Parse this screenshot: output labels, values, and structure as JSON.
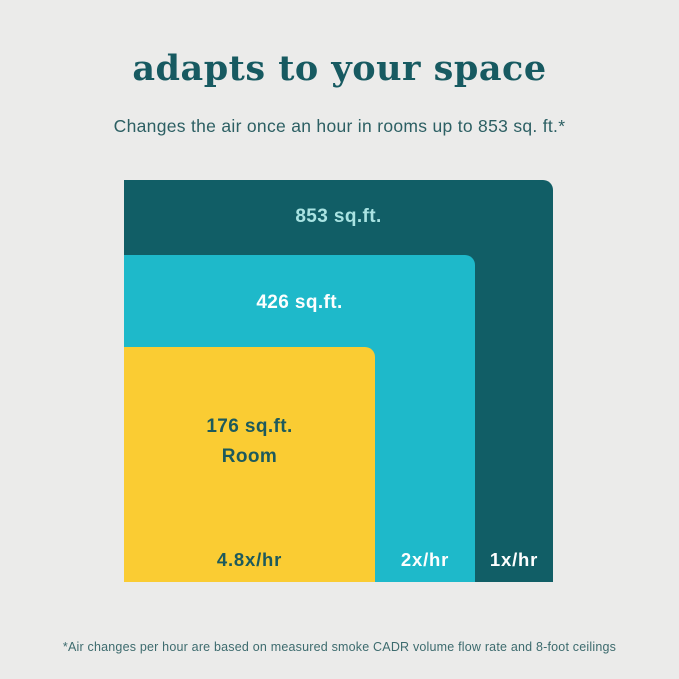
{
  "header": {
    "title": "adapts to your space",
    "subtitle": "Changes the air once an hour in rooms up to 853 sq. ft.*"
  },
  "diagram": {
    "rooms": [
      {
        "label": "853 sq.ft.",
        "rate": "1x/hr",
        "sqft": 853,
        "color": "#115E66"
      },
      {
        "label": "426 sq.ft.",
        "rate": "2x/hr",
        "sqft": 426,
        "color": "#1EB9CA"
      },
      {
        "label": "176 sq.ft.",
        "sublabel": "Room",
        "rate": "4.8x/hr",
        "sqft": 176,
        "color": "#FACC33"
      }
    ]
  },
  "footer": {
    "note": "*Air changes per hour are based on measured smoke CADR volume flow rate and 8-foot ceilings"
  },
  "colors": {
    "background": "#EBEBEA",
    "dark_teal": "#115E66",
    "cyan": "#1EB9CA",
    "yellow": "#FACC33",
    "title_text": "#175A61",
    "light_cyan_label": "#A9E3E2",
    "white_label": "#FDFEFE",
    "dark_label": "#1D5A5C",
    "footnote_text": "#3D6B6E"
  },
  "chart_data": {
    "type": "area",
    "title": "adapts to your space",
    "subtitle": "Changes the air once an hour in rooms up to 853 sq. ft.*",
    "categories": [
      "853 sq.ft.",
      "426 sq.ft.",
      "176 sq.ft. Room"
    ],
    "series": [
      {
        "name": "853 sq.ft.",
        "room_sqft": 853,
        "air_changes_per_hour": 1,
        "rate_label": "1x/hr",
        "color": "#115E66"
      },
      {
        "name": "426 sq.ft.",
        "room_sqft": 426,
        "air_changes_per_hour": 2,
        "rate_label": "2x/hr",
        "color": "#1EB9CA"
      },
      {
        "name": "176 sq.ft. Room",
        "room_sqft": 176,
        "air_changes_per_hour": 4.8,
        "rate_label": "4.8x/hr",
        "color": "#FACC33"
      }
    ],
    "legend_position": "none",
    "grid": false,
    "annotations": [
      "*Air changes per hour are based on measured smoke CADR volume flow rate and 8-foot ceilings"
    ],
    "layout": "nested rectangles anchored bottom-left, larger room = larger rectangle"
  }
}
